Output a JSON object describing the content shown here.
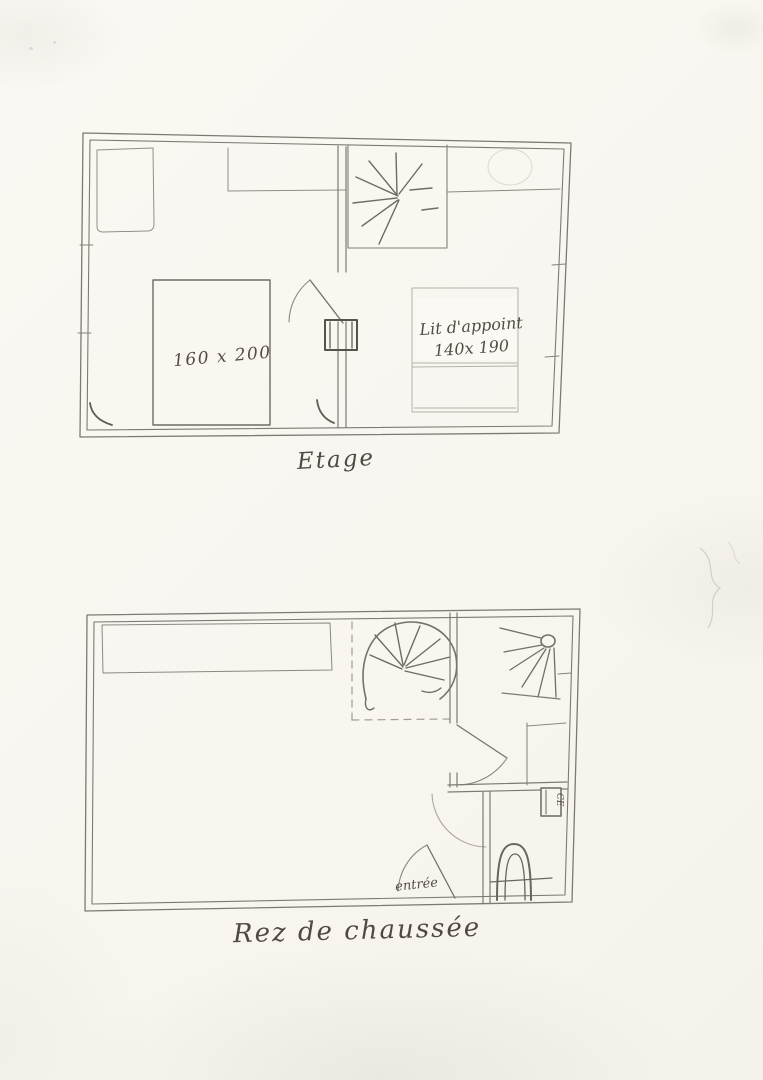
{
  "paper": {
    "background": "#f8f6ef",
    "pencil": "#7d7a73",
    "pencil_dark": "#57544c",
    "pencil_light": "#b4b0a6"
  },
  "plans": {
    "etage": {
      "caption": "Etage",
      "bed_label": "160 x 200",
      "spare_bed_label_line1": "Lit d'appoint",
      "spare_bed_label_line2": "140x 190"
    },
    "rez": {
      "caption": "Rez de chaussée",
      "entrance_label": "entrée",
      "wall_box_label": "CE"
    }
  },
  "symbols": {
    "staircase": "spiral-staircase-radiating-lines",
    "ceiling_light": "circle-with-rays",
    "toilet": "horseshoe-arch",
    "door": "quarter-arc-swing"
  }
}
